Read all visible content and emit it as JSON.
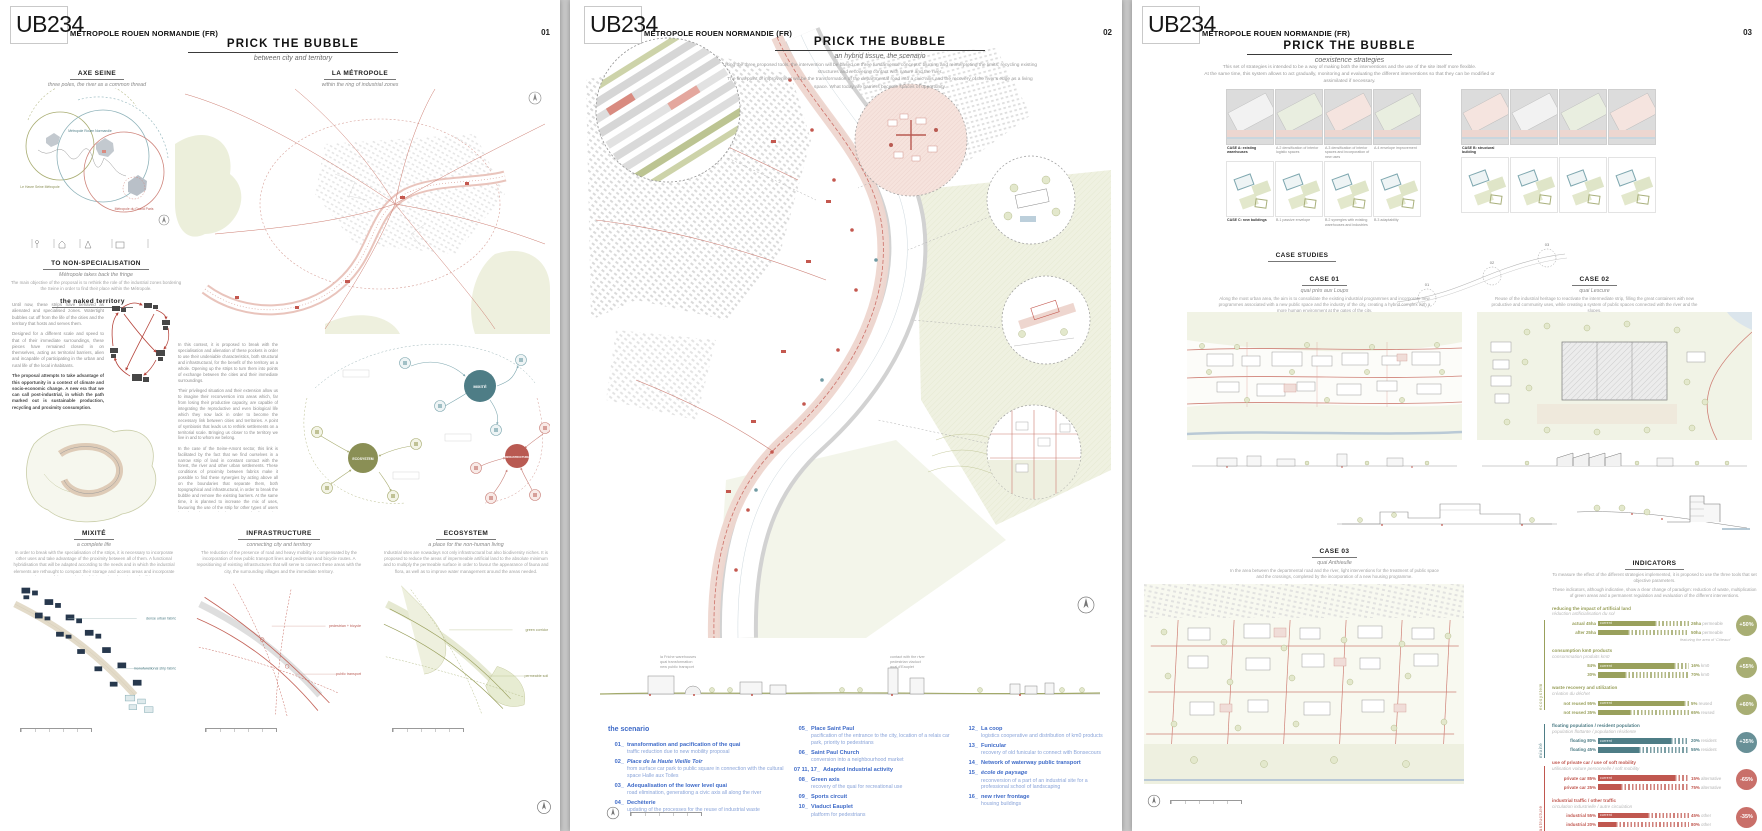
{
  "board": {
    "logo": "UB234",
    "client": "MÉTROPOLE ROUEN NORMANDIE (FR)",
    "title": "PRICK THE BUBBLE"
  },
  "p1": {
    "number": "01",
    "subtitle": "between city and territory",
    "axe_seine": {
      "title": "AXE SEINE",
      "subtitle": "three poles, the river as a common thread",
      "label_rouen": "Métropole Rouen Normandie",
      "label_havre": "Le Havre Seine Métropole",
      "label_paris": "Métropole du Grand Paris"
    },
    "non_spec": {
      "title": "TO NON-SPECIALISATION",
      "subtitle": "Métropole takes back the fringe",
      "caption": "The main objective of the proposal is to rethink the role of the industrial zones bordering the Seine in order to find their place within the Métropole."
    },
    "naked": {
      "title": "the naked territory",
      "p1": "Until now, these strips have behaved as alienated and specialised zones. Watertight bubbles cut off from the life of the cities and the territory that hosts and serves them.",
      "p2": "Designed for a different scale and speed to that of their immediate surroundings, these pieces have remained closed in on themselves, acting as territorial barriers, alien and incapable of participating in the urban and rural life of the local inhabitants.",
      "p3": "The proposal attempts to take advantage of this opportunity in a context of climate and socio-economic change. A new era that we can call post-industrial, in which the path marked out is sustainable production, recycling and proximity consumption."
    },
    "metropole_map": {
      "title": "LA MÉTROPOLE",
      "subtitle": "within the ring of industrial zones"
    },
    "context": {
      "p1": "In this context, it is proposed to break with the specialisation and alienation of these pockets in order to use their undeniable characteristics, both structural and infrastructural, for the benefit of the territory as a whole. Opening up the strips to turn them into points of exchange between the cities and their immediate surroundings.",
      "p2": "Their privileged situation and their extension allow us to imagine their reconversion into areas which, far from losing their productive capacity, are capable of integrating the reproductive and even biological life which they now lack in order to become the necessary link between cities and territories. A point of symbiosis that leads us to rethink settlements on a territorial scale. Bringing us closer to the territory we live in and to whom we belong.",
      "p3": "In the case of the Seine-Amont sector, this link is facilitated by the fact that we find ourselves in a narrow strip of land in constant contact with the forest, the river and other urban settlements. These conditions of proximity between fabrics make it possible to find these synergies by acting above all on the boundaries that separate them, both topographical and infrastructural, in order to break the bubble and remove the existing barriers. At the same time, it is planned to increase the mix of uses, favouring the use of the strip for other types of users in order to be recognised as a new pole of attraction with a territorial vocation."
    },
    "network": {
      "hub_mixite": "MIXITÉ",
      "hub_eco": "ECOSYSTEM",
      "hub_infra": "INFRASTRUCTURE"
    },
    "strategies": [
      {
        "title": "MIXITÉ",
        "subtitle": "a complete life",
        "caption": "In order to break with the specialisation of the strips, it is necessary to incorporate other uses and take advantage of the proximity between all of them. A functional hybridisation that will be adapted according to the needs and in which the industrial elements are rethought to compact their storage and access areas and incorporate elements of the reproductive fabric such as housing or facilities.",
        "label1": "dense urban fabric",
        "label2": "monofunctional strip fabric"
      },
      {
        "title": "INFRASTRUCTURE",
        "subtitle": "connecting city and territory",
        "caption": "The reduction of the presence of road and heavy mobility is compensated by the incorporation of new public transport lines and pedestrian and bicycle routes. A repositioning of existing infrastructures that will serve to connect these areas with the city, the surrounding villages and the immediate territory.",
        "label1": "pedestrian + bicycle",
        "label2": "public transport"
      },
      {
        "title": "ECOSYSTEM",
        "subtitle": "a place for the non-human living",
        "caption": "Industrial sites are nowadays not only infrastructural but also biodiversity niches. It is proposed to reduce the areas of impermeable artificial land to the absolute minimum and to multiply the permeable surface in order to favour the appearance of fauna and flora, as well as to improve water management around the areas needed.",
        "label1": "green corridor",
        "label2": "permeable soil"
      }
    ]
  },
  "p2": {
    "number": "02",
    "subtitle": "an hybrid tissue, the scenario",
    "intro1": "Using the three proposed tools, the intervention will be based on three fundamental concepts: blurring and reinterpreting the limits, recycling existing structures and recovering contact with nature and the river.",
    "intro2": "The final point of improvement will be the transformation of the departmental road into a civic axis and the recovery of the river's edge as a living space. What today are barriers become spaces of opportunity.",
    "section_notes": [
      "la Friche warehouses",
      "quai transformation",
      "new public transport",
      "contact with the river",
      "pedestrian viaduct",
      "quai d'Eauplet"
    ],
    "scenario": {
      "title": "the scenario",
      "col1": [
        {
          "num": "01_",
          "title": "transformation and pacification of the quai",
          "desc": "traffic reduction due to new mobility proposal"
        },
        {
          "num": "02_",
          "title": "Place de la Haute Vieille Toir",
          "desc": "from surface car park to public square in connection with the cultural space Halle aux Toiles"
        },
        {
          "num": "03_",
          "title": "Adequalisation of the lower level quai",
          "desc": "road elimination, generationg a civic axis all along the river"
        },
        {
          "num": "04_",
          "title": "Dechèterie",
          "desc": "updating of the processes for the reuse of industrial waste"
        }
      ],
      "col2": [
        {
          "num": "05_",
          "title": "Place Saint Paul",
          "desc": "pacification of the entrance to the city, location of a relais car park, priority to pedestrians"
        },
        {
          "num": "06_",
          "title": "Saint Paul Church",
          "desc": "conversion into a neighbourhood market"
        },
        {
          "num": "07 11, 17_",
          "title": "Adapted industrial activity",
          "desc": ""
        },
        {
          "num": "08_",
          "title": "Green axis",
          "desc": "recovery of the quai for recreational use"
        },
        {
          "num": "09_",
          "title": "Sports circuit",
          "desc": ""
        },
        {
          "num": "10_",
          "title": "Viaduct Eauplet",
          "desc": "platform for pedestrians"
        }
      ],
      "col3": [
        {
          "num": "12_",
          "title": "La coop",
          "desc": "logistics cooperative and distribution of km0 products"
        },
        {
          "num": "13_",
          "title": "Funicular",
          "desc": "recovery of old funicular to connect with Bonsecours"
        },
        {
          "num": "14_",
          "title": "Network of waterway public transport",
          "desc": ""
        },
        {
          "num": "15_",
          "title": "école de paysage",
          "desc": "reconversion of a part of an industrial site for a professional school of landscaping"
        },
        {
          "num": "16_",
          "title": "new river frontage",
          "desc": "housing buildings"
        }
      ]
    }
  },
  "p3": {
    "number": "03",
    "subtitle": "coexistence strategies",
    "intro1": "This set of strategies is intended to be a way of making both the interventions and the use of the site itself more flexible.",
    "intro2": "At the same time, this system allows to act gradually, monitoring and evaluating the different interventions so that they can be modified or assimilated if necessary.",
    "grids": {
      "rowA": [
        "CASE A: existing warehouses",
        "A.2 densification of interior logistic spaces",
        "A.3 densification of interior spaces and incorporation of new uses",
        "A.4 envelope improvement"
      ],
      "rowB": [
        "CASE B: structural building",
        "",
        "",
        ""
      ],
      "rowC": [
        "CASE C: new buildings",
        "B.1 passive envelope",
        "B.2 synergies with existing warehouses and industries",
        "B.3 adaptability"
      ],
      "rowD": [
        "",
        "",
        "",
        ""
      ]
    },
    "case_studies_title": "CASE STUDIES",
    "case01": {
      "title": "CASE 01",
      "subtitle": "quai près aux Loups",
      "caption": "Along the most urban area, the aim is to consolidate the existing industrial programmes and incorporate new programmes associated with a new public space and the industry of the city, creating a hybrid complex with a more human environment at the gates of the city."
    },
    "case02": {
      "title": "CASE 02",
      "subtitle": "quai Lescure",
      "caption": "Reuse of the industrial heritage to reactivate the intermediate strip, filling the great containers with new productive and community uses, while creating a system of public spaces connected with the river and the slopes."
    },
    "case03": {
      "title": "CASE 03",
      "subtitle": "quai Anthieulle",
      "caption": "In the area between the departmental road and the river, light interventions for the treatment of public space and the crossings, completed by the incorporation of a new housing programme."
    },
    "indicators": {
      "title": "INDICATORS",
      "intro1": "To measure the effect of the different strategies implemented, it is proposed to use the three tools that set objective parameters.",
      "intro2": "These indicators, although indicative, show a clear change of paradigm: reduction of waste, multiplication of green areas and a permanent regulation and evaluation of the different interventions."
    }
  },
  "chart_data": {
    "type": "bar",
    "title": "INDICATORS",
    "legend_position": "right",
    "current_label": "current",
    "side_labels": [
      "ecosystem",
      "mixité",
      "infrastructure"
    ],
    "groups": [
      {
        "category": "ecosystem",
        "label_en": "reducing the impact of artificial land",
        "label_fr": "réduction artificialisation du sol",
        "rows": [
          {
            "left": "actual 45ha",
            "solid_pct": 63,
            "right": "26ha",
            "right_light": "permeable"
          },
          {
            "left": "after 25ha",
            "solid_pct": 33,
            "right": "50ha",
            "right_light": "permeable"
          }
        ],
        "badge": "+50%",
        "note": "featuring the area of ‘Côteaux’"
      },
      {
        "category": "ecosystem",
        "label_en": "consumption km0 products",
        "label_fr": "consommation produits km0",
        "rows": [
          {
            "left": "84%",
            "solid_pct": 84,
            "right": "16%",
            "right_light": "km0"
          },
          {
            "left": "30%",
            "solid_pct": 30,
            "right": "70%",
            "right_light": "km0"
          }
        ],
        "badge": "+55%",
        "note": ""
      },
      {
        "category": "ecosystem",
        "label_en": "waste recovery and utilization",
        "label_fr": "création du déchet",
        "rows": [
          {
            "left": "not reused 95%",
            "solid_pct": 95,
            "right": "5%",
            "right_light": "reused"
          },
          {
            "left": "not reused 35%",
            "solid_pct": 35,
            "right": "65%",
            "right_light": "reused"
          }
        ],
        "badge": "+60%",
        "note": ""
      },
      {
        "category": "mixité",
        "label_en": "floating population / resident population",
        "label_fr": "population flottante / population résidente",
        "rows": [
          {
            "left": "floating 80%",
            "solid_pct": 80,
            "right": "20%",
            "right_light": "resident"
          },
          {
            "left": "floating 45%",
            "solid_pct": 45,
            "right": "55%",
            "right_light": "resident"
          }
        ],
        "badge": "+35%",
        "note": ""
      },
      {
        "category": "infrastructure",
        "label_en": "use of private car / use of soft mobility",
        "label_fr": "utilisation voiture personnelle / soft mobility",
        "rows": [
          {
            "left": "private car 85%",
            "solid_pct": 85,
            "right": "15%",
            "right_light": "alternative"
          },
          {
            "left": "private car 25%",
            "solid_pct": 25,
            "right": "75%",
            "right_light": "alternative"
          }
        ],
        "badge": "-65%",
        "note": ""
      },
      {
        "category": "infrastructure",
        "label_en": "industrial traffic / other traffic",
        "label_fr": "circulation industrielle / autre circulation",
        "rows": [
          {
            "left": "industrial 55%",
            "solid_pct": 55,
            "right": "45%",
            "right_light": "other"
          },
          {
            "left": "industrial 20%",
            "solid_pct": 20,
            "right": "80%",
            "right_light": "other"
          }
        ],
        "badge": "-35%",
        "note": ""
      }
    ]
  }
}
